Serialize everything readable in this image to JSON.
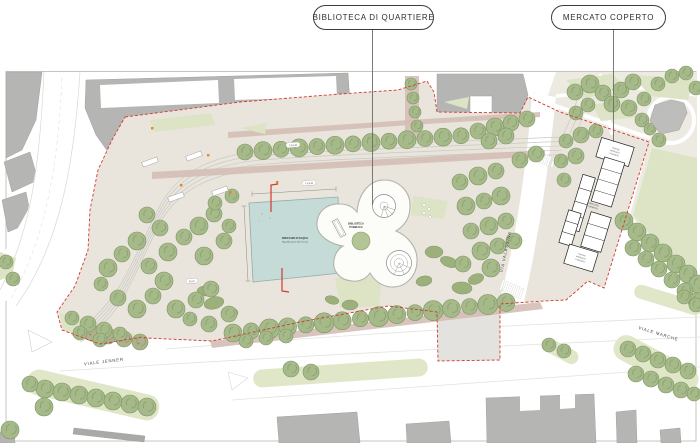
{
  "callouts": [
    {
      "label": "BIBLIOTECA DI QUARTIERE"
    },
    {
      "label": "MERCATO COPERTO"
    }
  ],
  "map": {
    "street_labels": {
      "jenner": "VIALE JENNER",
      "valassina": "VIA VALASSINA",
      "marche": "VIALE MARCHE"
    },
    "labels": {
      "library1": "BIBLIOTECA",
      "library2": "PUBBLICA",
      "pool1": "SPECCHIO D'ACQUA",
      "pool2": "Riqualificazione del mercato",
      "market1": "MERCATO",
      "market2": "COPERTO",
      "stall1": "NUOVO",
      "stall2": "MERCATO",
      "stall3": "COPERTO"
    },
    "transit": {
      "tram": "TRAM",
      "bus": "BUS"
    },
    "colors": {
      "site": "#e9e5dc",
      "park": "#edeae1",
      "lawn": "#dce4c5",
      "median": "#e0e7c9",
      "tree": "#a5b989",
      "tree_edge": "#7e9464",
      "tree_street": "#aeb28c",
      "shrub": "#9bb07b",
      "shrub_edge": "#86996a",
      "water": "#c5dbd7",
      "water_edge": "#94aca7",
      "path": "#d4beb5",
      "building": "#b5b5b3",
      "building_edge": "#a2a2a0",
      "stall_edge": "#1f1f1f",
      "boundary": "#cf3a30",
      "accent": "#e2852b",
      "track": "#c9c9c5",
      "road_line": "#dedede",
      "leader": "#6b6b6b",
      "ink": "#3c3c3c"
    }
  }
}
